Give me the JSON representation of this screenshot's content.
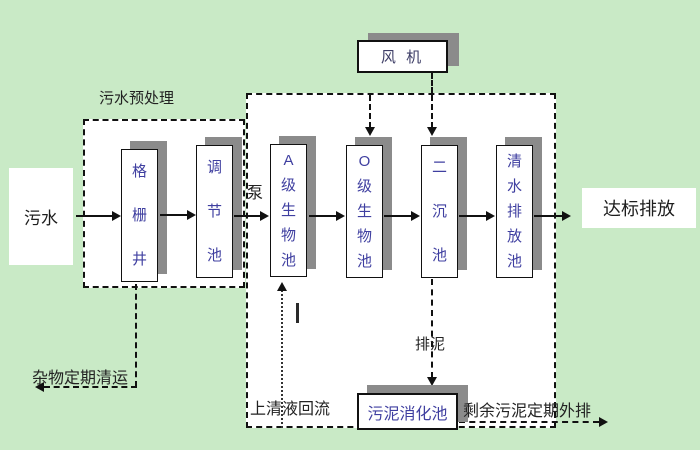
{
  "colors": {
    "background": "#c9eac6",
    "shadow": "#8b8b8b",
    "tank_text": "#3f3fa0",
    "label_text": "#222222"
  },
  "diagram": {
    "pretreatment_label": "污水预处理",
    "influent": "污水",
    "pump": "泵",
    "fan": "风 机",
    "boxes": {
      "grid_well": "格栅井",
      "regulating_tank": "调节池",
      "a_bio_tank": "A级生物池",
      "o_bio_tank": "O级生物池",
      "secondary_clarifier": "二沉池",
      "clear_water_tank": "清水排放池",
      "sludge_digester": "污泥消化池"
    },
    "discharge": "达标排放",
    "debris_label": "杂物定期清运",
    "supernatant_label": "上清液回流",
    "sludge_label": "排泥",
    "excess_sludge_label": "剩余污泥定期外排"
  }
}
